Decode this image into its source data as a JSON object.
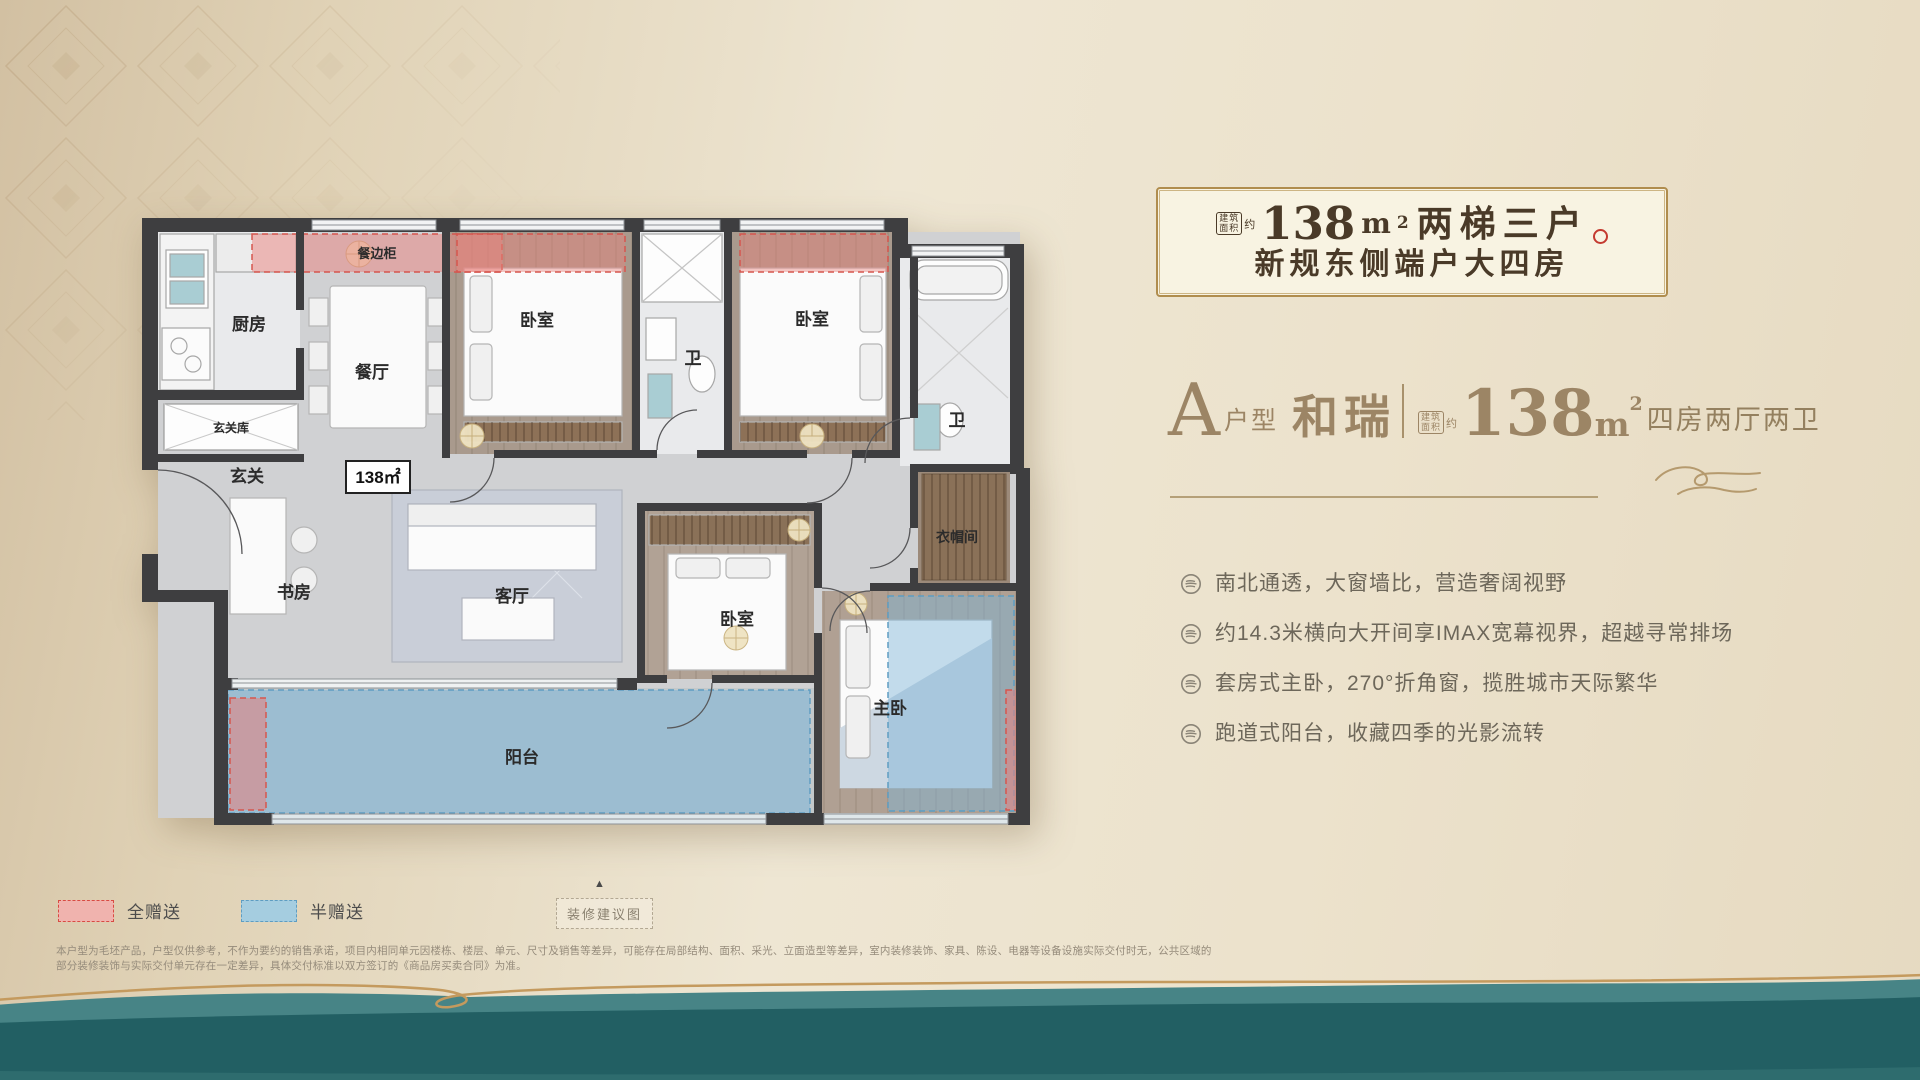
{
  "header": {
    "area_badge_line1": "建筑",
    "area_badge_line2": "面积",
    "approx": "约",
    "area_number": "138",
    "area_unit": "m",
    "area_sup": "2",
    "line1_rest": "两梯三户",
    "line2": "新规东侧端户大四房"
  },
  "spec": {
    "type_letter": "A",
    "type_label": "户型",
    "name": "和瑞",
    "area_badge_line1": "建筑",
    "area_badge_line2": "面积",
    "approx": "约",
    "area_number": "138",
    "area_unit": "m",
    "area_sup": "2",
    "rooms_text": "四房两厅两卫"
  },
  "features": [
    "南北通透，大窗墙比，营造奢阔视野",
    "约14.3米横向大开间享IMAX宽幕视界，超越寻常排场",
    "套房式主卧，270°折角窗，揽胜城市天际繁华",
    "跑道式阳台，收藏四季的光影流转"
  ],
  "floorplan": {
    "area_label": "138㎡",
    "rooms": {
      "dining_cabinet": "餐边柜",
      "kitchen": "厨房",
      "dining": "餐厅",
      "entry_storage": "玄关库",
      "entry": "玄关",
      "bedroom": "卧室",
      "bath": "卫",
      "study": "书房",
      "living": "客厅",
      "cloakroom": "衣帽间",
      "master": "主卧",
      "balcony": "阳台"
    }
  },
  "legend": {
    "full_gift": "全赠送",
    "half_gift": "半赠送"
  },
  "footer": {
    "marker": "▲",
    "suggestion_tag": "装修建议图",
    "disclaimer": "本户型为毛坯产品，户型仅供参考，不作为要约的销售承诺，项目内相同单元因楼栋、楼层、单元、尺寸及销售等差异，可能存在局部结构、面积、采光、立面造型等差异，室内装修装饰、家具、陈设、电器等设备设施实际交付时无，公共区域的部分装修装饰与实际交付单元存在一定差异，具体交付标准以双方签订的《商品房买卖合同》为准。"
  },
  "colors": {
    "gold_border": "#b08d4e",
    "title_brown": "#4a3a28",
    "bronze": "#9c8565",
    "seal_red": "#c43a30",
    "gift_full_border": "#d84b42",
    "gift_full_fill": "#f0b3ae",
    "gift_half_border": "#5e9dc2",
    "gift_half_fill": "#a5cde0",
    "teal_dark": "#225f63",
    "teal_light": "#478486",
    "wall": "#3e3e40"
  }
}
